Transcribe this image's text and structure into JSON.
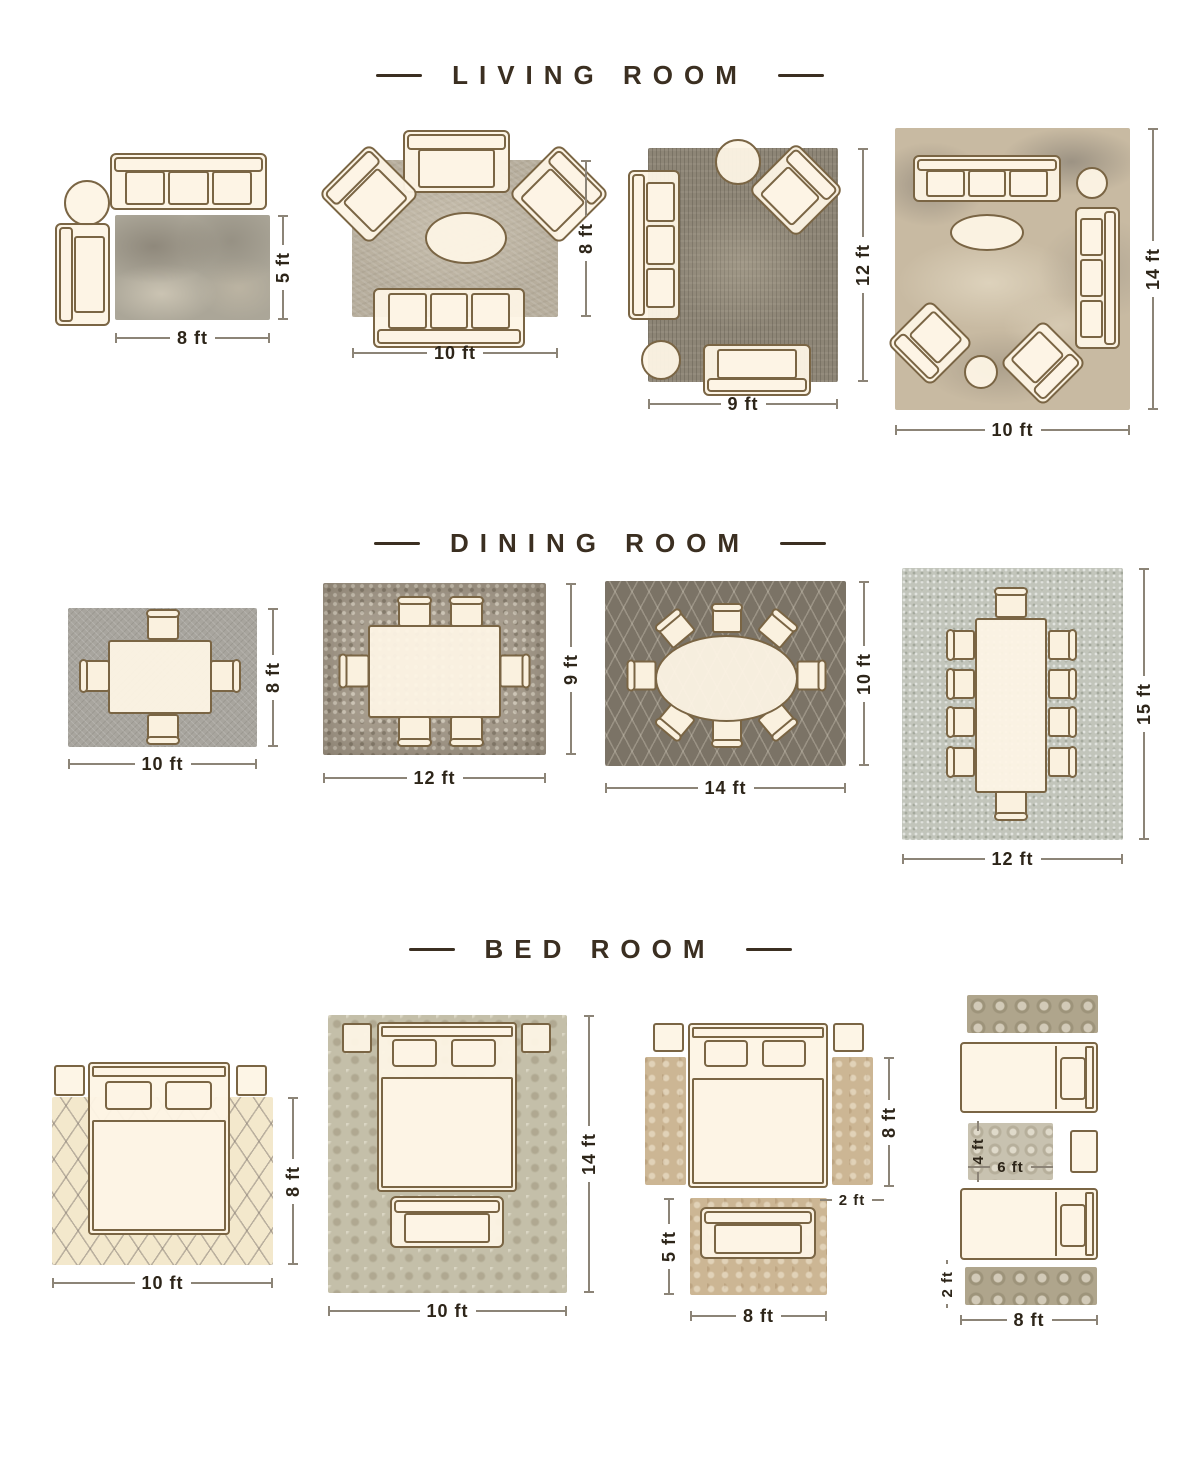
{
  "colors": {
    "page_background": "#ffffff",
    "title_text": "#3b2f21",
    "dimension_text": "#2d2519",
    "dimension_line": "#8c8477",
    "furniture_fill": "#fdf4e5",
    "furniture_outline": "#7a6544"
  },
  "sections": {
    "living": {
      "title": "LIVING ROOM",
      "layouts": [
        {
          "width": "8 ft",
          "height": "5 ft"
        },
        {
          "width": "10 ft",
          "height": "8 ft"
        },
        {
          "width": "9 ft",
          "height": "12 ft"
        },
        {
          "width": "10 ft",
          "height": "14 ft"
        }
      ]
    },
    "dining": {
      "title": "DINING ROOM",
      "layouts": [
        {
          "width": "10 ft",
          "height": "8 ft"
        },
        {
          "width": "12 ft",
          "height": "9 ft"
        },
        {
          "width": "14 ft",
          "height": "10 ft"
        },
        {
          "width": "12 ft",
          "height": "15 ft"
        }
      ]
    },
    "bed": {
      "title": "BED ROOM",
      "layouts": [
        {
          "width": "10 ft",
          "height": "8 ft"
        },
        {
          "width": "10 ft",
          "height": "14 ft"
        },
        {
          "width": "8 ft",
          "runner_height": "8 ft",
          "runner_width": "2 ft",
          "front_rug_height": "5 ft"
        },
        {
          "width": "8 ft",
          "runner_height": "2 ft",
          "center_rug_width": "6 ft",
          "center_rug_height": "4 ft"
        }
      ]
    }
  }
}
